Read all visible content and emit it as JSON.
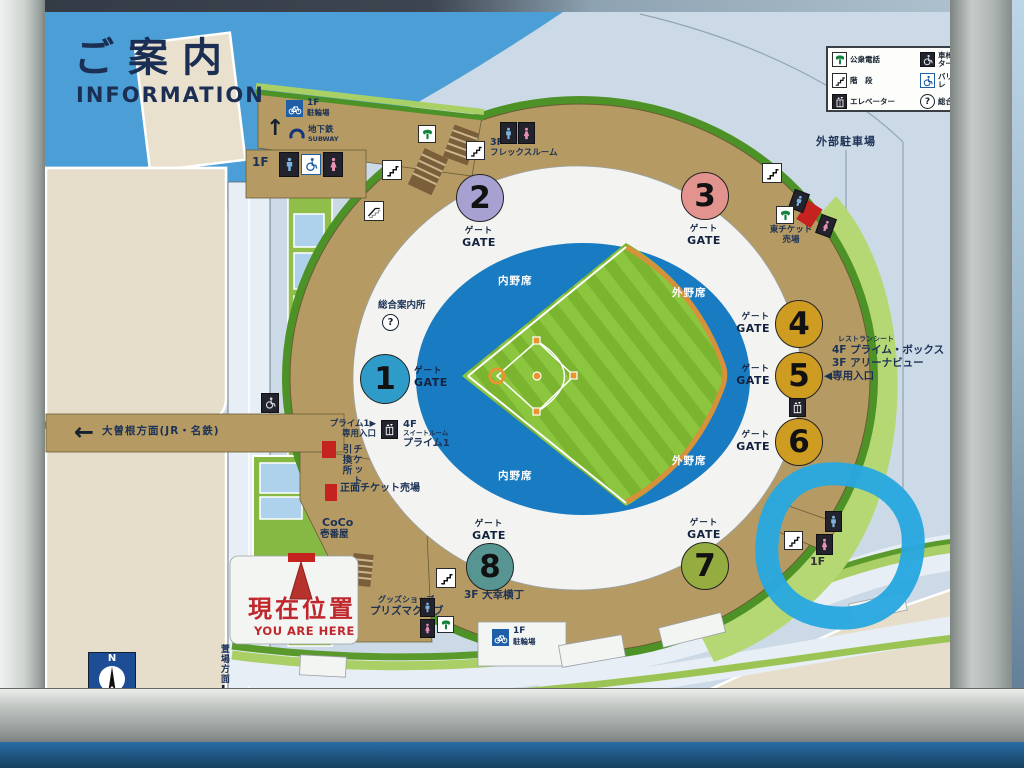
{
  "sign": {
    "title_jp": "ご案内",
    "title_en": "INFORMATION",
    "compass_n": "N"
  },
  "legend": {
    "items": [
      {
        "icon": "phone-icon",
        "label": "公衆電話"
      },
      {
        "icon": "stairs-icon",
        "label": "階　段"
      },
      {
        "icon": "elevator-icon",
        "label": "エレベーター"
      },
      {
        "icon": "wheelchair-elevator-icon",
        "label": "車椅子用エレベーター"
      },
      {
        "icon": "accessible-toilet-icon",
        "label": "バリアフリートイレ"
      },
      {
        "icon": "info-icon",
        "label": "総合案内所"
      }
    ]
  },
  "gate_label": {
    "jp": "ゲート",
    "en": "GATE"
  },
  "gates": [
    {
      "number": "1",
      "color": "#2e9bc9"
    },
    {
      "number": "2",
      "color": "#a7a1d1"
    },
    {
      "number": "3",
      "color": "#e2938e"
    },
    {
      "number": "4",
      "color": "#cf9c22"
    },
    {
      "number": "5",
      "color": "#cf9c22"
    },
    {
      "number": "6",
      "color": "#cf9c22"
    },
    {
      "number": "7",
      "color": "#95ac40"
    },
    {
      "number": "8",
      "color": "#579592"
    }
  ],
  "stadium": {
    "infield": "内野席",
    "outfield": "外野席"
  },
  "labels": {
    "outer_parking": "外部駐車場",
    "bicycle_floor": "1F",
    "bicycle": "駐輪場",
    "subway_arrow": "↑",
    "subway_jp": "地下鉄",
    "subway_en": "SUBWAY",
    "restroom_floor": "1F",
    "flex_floor": "3F",
    "flex_name": "フレックスルーム",
    "info_center": "総合案内所",
    "east_ticket_line1": "東チケット",
    "east_ticket_line2": "売場",
    "restaurant_seat": "レストランシート",
    "prime_box": "4F プライム・ボックス",
    "arena_view": "3F アリーナビュー",
    "dedicated_entrance": "◀専用入口",
    "prime1_line1": "プライム1▶",
    "prime1_line2": "専用入口",
    "suite_floor": "4F",
    "suite_room": "スイートルーム",
    "suite_name": "プライム1",
    "ozone_arrow": "←",
    "ozone_direction": "大曽根方面(JR・名鉄)",
    "ticket_exchange_1": "チケット",
    "ticket_exchange_2": "引換所",
    "main_ticket": "正面チケット売場",
    "coco_line1": "CoCo",
    "coco_line2": "壱番屋",
    "goods_shop": "グッズショップ",
    "prisma_club": "プリズマクラブ",
    "daiko_yokocho": "3F 大幸横丁",
    "kayaba_direction": "萱場方面",
    "kayaba_arrow": "↓",
    "highlight_floor": "1F",
    "current_location_jp": "現在位置",
    "current_location_en": "YOU ARE HERE"
  },
  "icons": {
    "info_glyph": "?"
  },
  "colors": {
    "highlight": "#29a8e0",
    "field_green": "#8cc63f",
    "stand_blue": "#197cc2",
    "concourse_tan": "#b59b63",
    "accent_red": "#c5231f",
    "title_navy": "#1b2f55"
  }
}
